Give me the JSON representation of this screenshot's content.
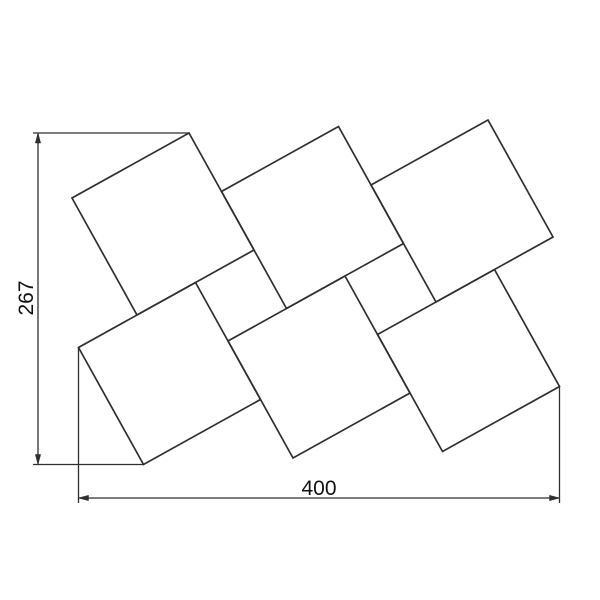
{
  "canvas": {
    "width": 600,
    "height": 600,
    "background": "#ffffff",
    "line_color": "#2f2f2f",
    "text_color": "#111111"
  },
  "drawing": {
    "kind": "technical-dimension-drawing",
    "subject": "six rotated square panels in a pinwheel arrangement, 2 rows x 3 columns",
    "squares": [
      {
        "id": "panel-top-left",
        "points": [
          [
            189,
            133
          ],
          [
            254,
            250
          ],
          [
            137,
            315
          ],
          [
            72,
            198
          ]
        ]
      },
      {
        "id": "panel-top-middle",
        "points": [
          [
            338.5,
            126.5
          ],
          [
            403.5,
            243.5
          ],
          [
            286.5,
            308.5
          ],
          [
            221.5,
            191.5
          ]
        ]
      },
      {
        "id": "panel-top-right",
        "points": [
          [
            488,
            120
          ],
          [
            553,
            237
          ],
          [
            436,
            302
          ],
          [
            371,
            185
          ]
        ]
      },
      {
        "id": "panel-bottom-left",
        "points": [
          [
            195.5,
            282.5
          ],
          [
            260.5,
            399.5
          ],
          [
            143.5,
            464.5
          ],
          [
            78.5,
            347.5
          ]
        ]
      },
      {
        "id": "panel-bottom-middle",
        "points": [
          [
            345,
            276
          ],
          [
            410,
            393
          ],
          [
            293,
            458
          ],
          [
            228,
            341
          ]
        ]
      },
      {
        "id": "panel-bottom-right",
        "points": [
          [
            494.5,
            269.5
          ],
          [
            559.5,
            386.5
          ],
          [
            442.5,
            451.5
          ],
          [
            377.5,
            334.5
          ]
        ]
      }
    ]
  },
  "dimensions": {
    "vertical": {
      "label": "267",
      "dim_line": [
        38,
        133,
        38,
        464.5
      ],
      "extension_lines": [
        [
          33,
          133,
          189,
          133
        ],
        [
          33,
          464.5,
          143.5,
          464.5
        ]
      ],
      "arrows": [
        [
          38,
          133,
          35.3,
          143,
          40.7,
          143
        ],
        [
          38,
          464.5,
          35.3,
          454.5,
          40.7,
          454.5
        ]
      ]
    },
    "horizontal": {
      "label": "400",
      "dim_line": [
        78.5,
        498,
        559.5,
        498
      ],
      "extension_lines": [
        [
          78.5,
          347.5,
          78.5,
          503
        ],
        [
          559.5,
          386.5,
          559.5,
          503
        ]
      ],
      "arrows": [
        [
          78.5,
          498,
          88.5,
          495.3,
          88.5,
          500.7
        ],
        [
          559.5,
          498,
          549.5,
          495.3,
          549.5,
          500.7
        ]
      ]
    }
  }
}
